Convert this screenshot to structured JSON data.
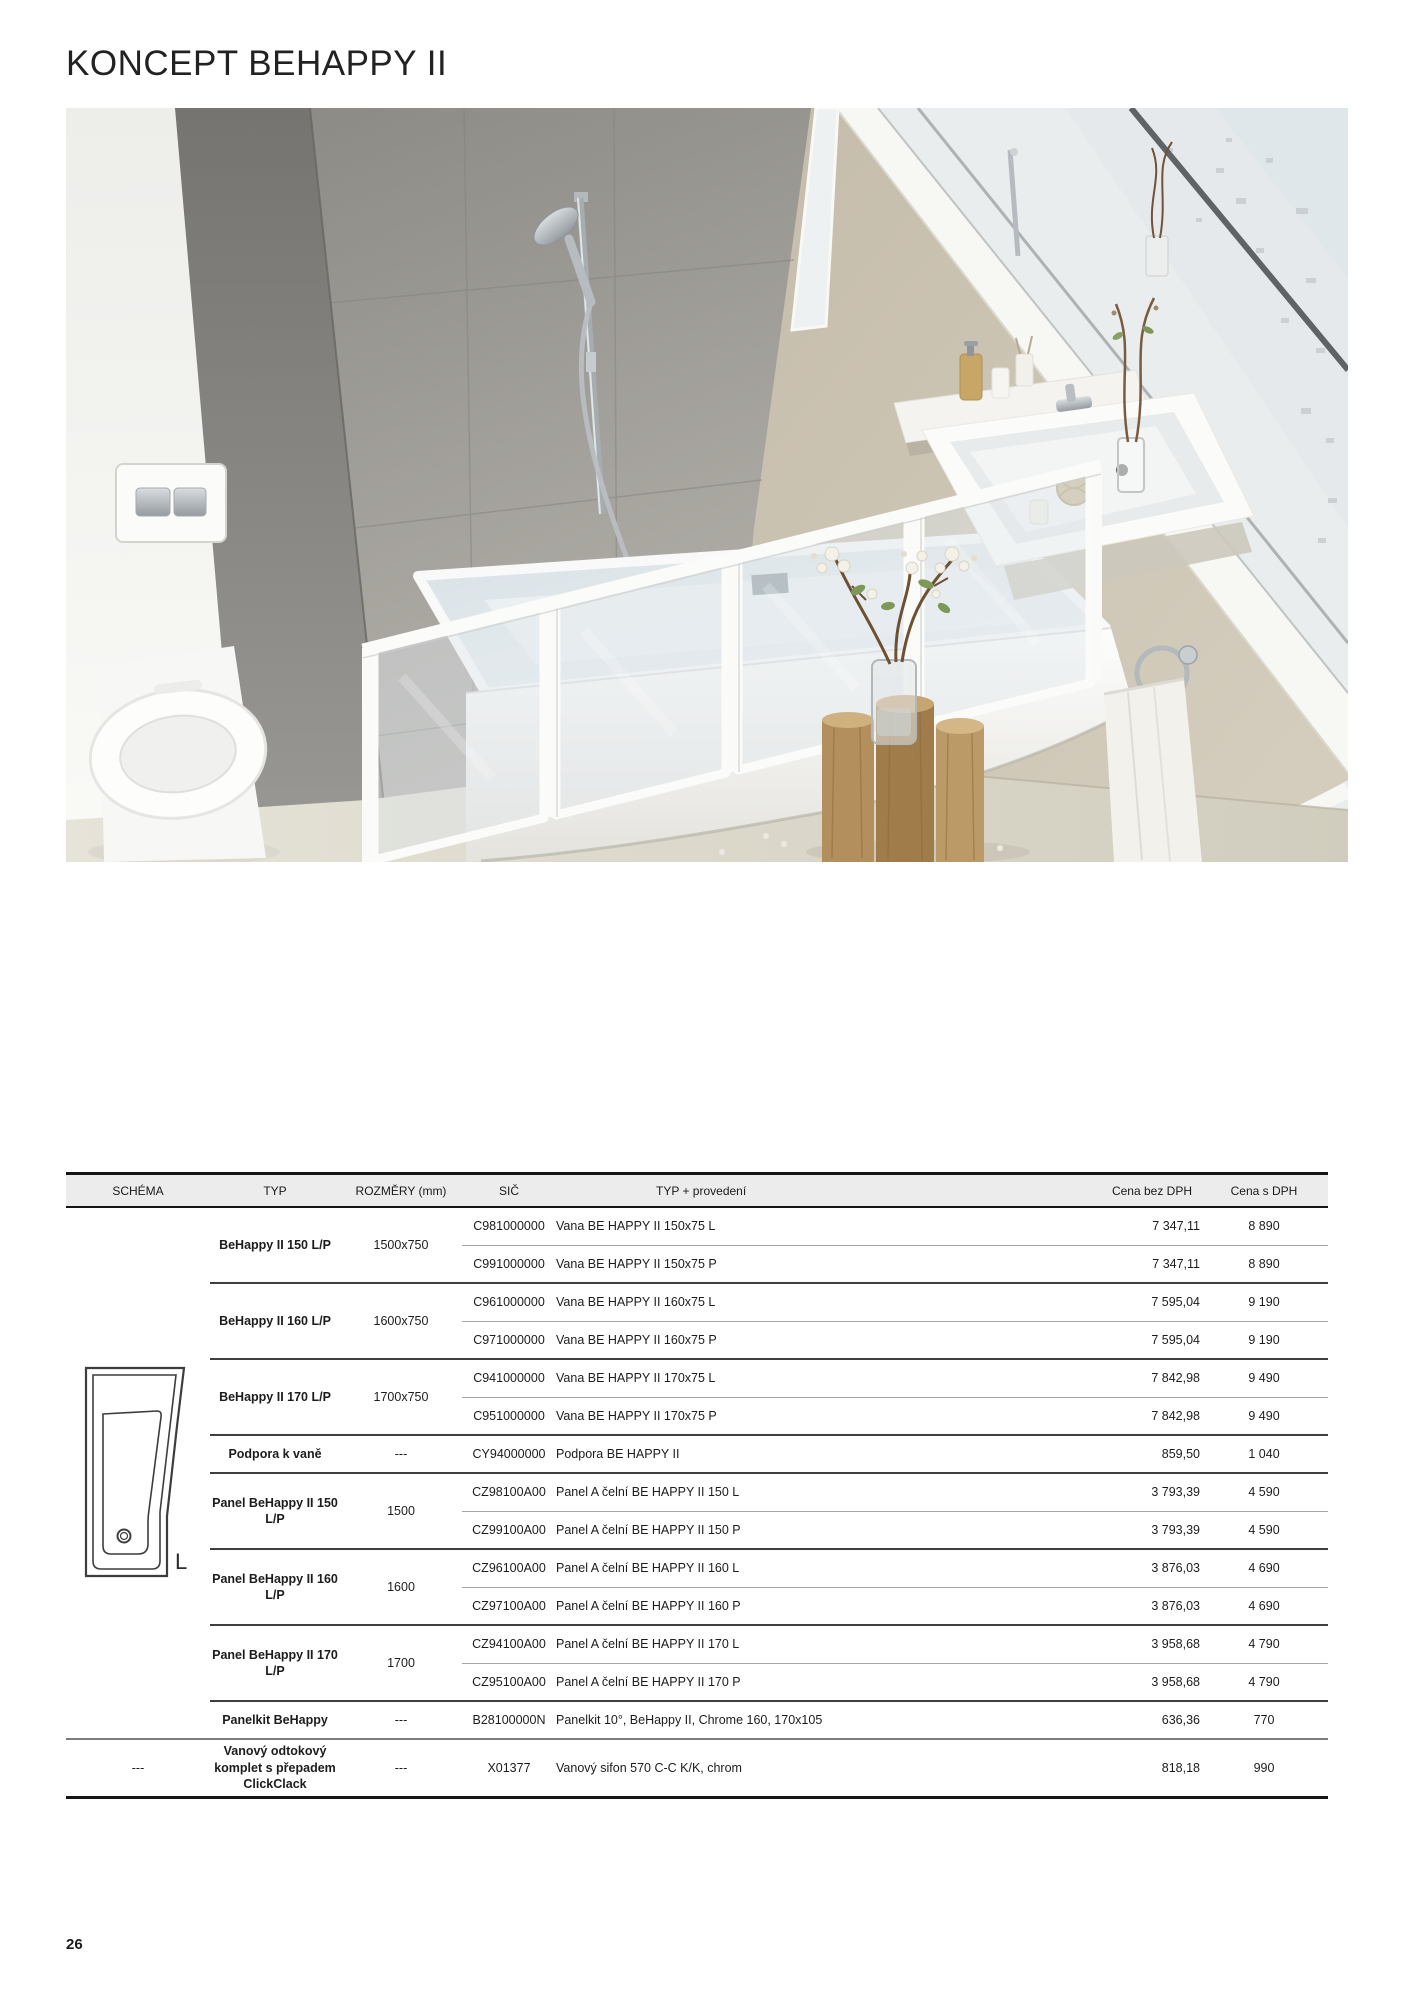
{
  "page": {
    "title": "KONCEPT BEHAPPY II",
    "page_number": "26"
  },
  "schema": {
    "label": "L"
  },
  "table": {
    "headers": [
      "SCHÉMA",
      "TYP",
      "ROZMĚRY (mm)",
      "SIČ",
      "TYP + provedení",
      "Cena bez DPH",
      "Cena s DPH"
    ],
    "groups": [
      {
        "typ": "BeHappy II 150 L/P",
        "rozmery": "1500x750",
        "items": [
          {
            "sic": "C981000000",
            "desc": "Vana BE HAPPY II 150x75 L",
            "cena_bez": "7 347,11",
            "cena_s": "8 890"
          },
          {
            "sic": "C991000000",
            "desc": "Vana BE HAPPY II 150x75 P",
            "cena_bez": "7 347,11",
            "cena_s": "8 890"
          }
        ]
      },
      {
        "typ": "BeHappy II 160 L/P",
        "rozmery": "1600x750",
        "items": [
          {
            "sic": "C961000000",
            "desc": "Vana BE HAPPY II 160x75 L",
            "cena_bez": "7 595,04",
            "cena_s": "9 190"
          },
          {
            "sic": "C971000000",
            "desc": "Vana BE HAPPY II 160x75 P",
            "cena_bez": "7 595,04",
            "cena_s": "9 190"
          }
        ]
      },
      {
        "typ": "BeHappy II 170 L/P",
        "rozmery": "1700x750",
        "items": [
          {
            "sic": "C941000000",
            "desc": "Vana BE HAPPY II 170x75 L",
            "cena_bez": "7 842,98",
            "cena_s": "9 490"
          },
          {
            "sic": "C951000000",
            "desc": "Vana BE HAPPY II 170x75 P",
            "cena_bez": "7 842,98",
            "cena_s": "9 490"
          }
        ]
      },
      {
        "typ": "Podpora k vaně",
        "rozmery": "---",
        "items": [
          {
            "sic": "CY94000000",
            "desc": "Podpora BE HAPPY II",
            "cena_bez": "859,50",
            "cena_s": "1 040"
          }
        ]
      },
      {
        "typ": "Panel BeHappy II 150 L/P",
        "rozmery": "1500",
        "items": [
          {
            "sic": "CZ98100A00",
            "desc": "Panel A čelní BE HAPPY II 150 L",
            "cena_bez": "3 793,39",
            "cena_s": "4 590"
          },
          {
            "sic": "CZ99100A00",
            "desc": "Panel A čelní BE HAPPY II 150 P",
            "cena_bez": "3 793,39",
            "cena_s": "4 590"
          }
        ]
      },
      {
        "typ": "Panel BeHappy II 160 L/P",
        "rozmery": "1600",
        "items": [
          {
            "sic": "CZ96100A00",
            "desc": "Panel A čelní BE HAPPY II 160 L",
            "cena_bez": "3 876,03",
            "cena_s": "4 690"
          },
          {
            "sic": "CZ97100A00",
            "desc": "Panel A čelní BE HAPPY II 160 P",
            "cena_bez": "3 876,03",
            "cena_s": "4 690"
          }
        ]
      },
      {
        "typ": "Panel BeHappy II 170 L/P",
        "rozmery": "1700",
        "items": [
          {
            "sic": "CZ94100A00",
            "desc": "Panel A čelní BE HAPPY II 170 L",
            "cena_bez": "3 958,68",
            "cena_s": "4 790"
          },
          {
            "sic": "CZ95100A00",
            "desc": "Panel A čelní BE HAPPY II 170 P",
            "cena_bez": "3 958,68",
            "cena_s": "4 790"
          }
        ]
      },
      {
        "typ": "Panelkit BeHappy",
        "rozmery": "---",
        "items": [
          {
            "sic": "B28100000N",
            "desc": "Panelkit 10°, BeHappy II, Chrome 160, 170x105",
            "cena_bez": "636,36",
            "cena_s": "770"
          }
        ]
      }
    ],
    "last_row": {
      "schema": "---",
      "typ": "Vanový odtokový komplet s přepadem ClickClack",
      "rozmery": "---",
      "sic": "X01377",
      "desc": "Vanový sifon 570 C-C K/K, chrom",
      "cena_bez": "818,18",
      "cena_s": "990"
    }
  },
  "colors": {
    "accent_grey": "#ececec",
    "rule_dark": "#151515",
    "wall_beige": "#c3baa8",
    "tile_grey": "#a8a5a0"
  }
}
